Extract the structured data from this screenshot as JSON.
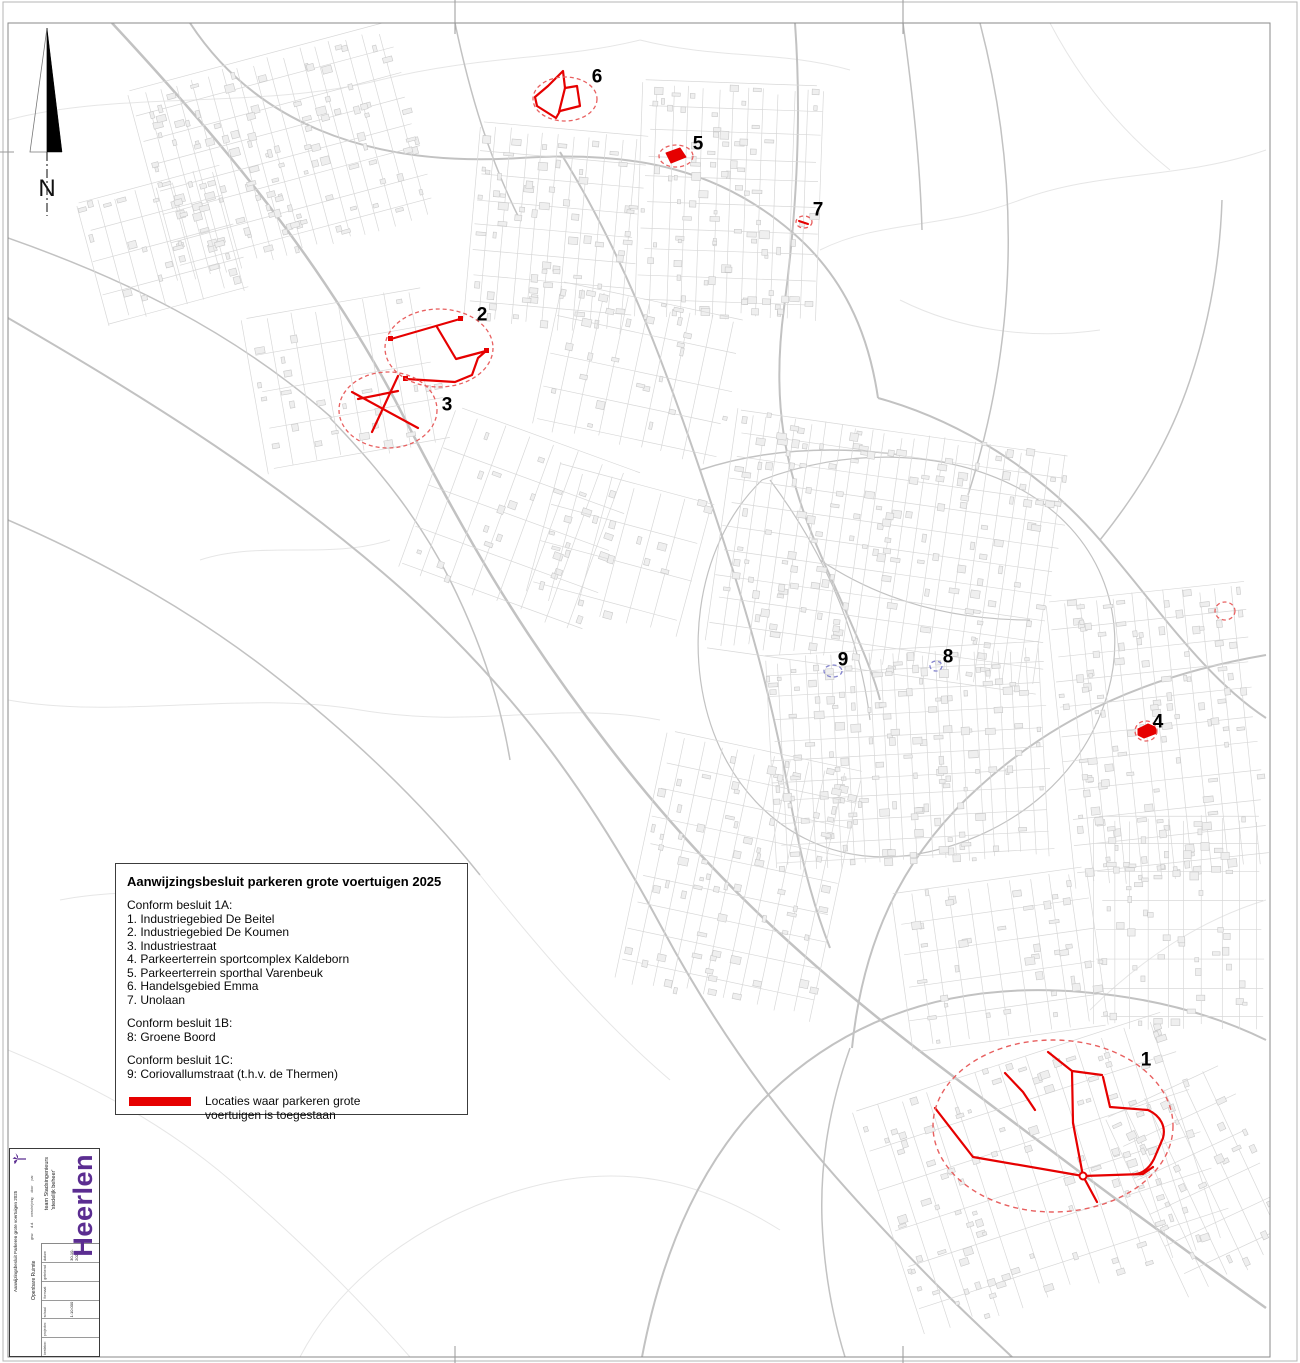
{
  "page": {
    "width": 1300,
    "height": 1363
  },
  "colors": {
    "zone_red": "#e60000",
    "zone_dash_red": "#e86060",
    "zone_dash_blue": "#8585cd",
    "brand_purple": "#5b2d91",
    "map_gray": "#d8d8d8"
  },
  "north_arrow": {
    "label": "N"
  },
  "legend": {
    "title": "Aanwijzingsbesluit parkeren grote voertuigen 2025",
    "sections": [
      {
        "header": "Conform besluit 1A:",
        "items": [
          "1. Industriegebied De Beitel",
          "2. Industriegebied De Koumen",
          "3. Industriestraat",
          "4. Parkeerterrein sportcomplex Kaldeborn",
          "5. Parkeerterrein sporthal Varenbeuk",
          "6. Handelsgebied Emma",
          "7. Unolaan"
        ]
      },
      {
        "header": "Conform besluit 1B:",
        "items": [
          "8: Groene Boord"
        ]
      },
      {
        "header": "Conform besluit 1C:",
        "items": [
          "9: Coriovallumstraat (t.h.v. de Thermen)"
        ]
      }
    ],
    "swatch_label": "Locaties waar parkeren grote voertuigen is toegestaan"
  },
  "markers": [
    {
      "id": "1",
      "label": "1",
      "lx": 1146,
      "ly": 1060,
      "cx": 1053,
      "cy": 1126,
      "rx": 120,
      "ry": 86,
      "color": "red"
    },
    {
      "id": "2",
      "label": "2",
      "lx": 482,
      "ly": 315,
      "cx": 439,
      "cy": 348,
      "rx": 54,
      "ry": 39,
      "color": "red"
    },
    {
      "id": "3",
      "label": "3",
      "lx": 447,
      "ly": 405,
      "cx": 388,
      "cy": 410,
      "rx": 49,
      "ry": 38,
      "color": "red"
    },
    {
      "id": "4",
      "label": "4",
      "lx": 1158,
      "ly": 722,
      "cx": 1146,
      "cy": 731,
      "rx": 11,
      "ry": 10,
      "color": "red"
    },
    {
      "id": "5",
      "label": "5",
      "lx": 698,
      "ly": 144,
      "cx": 676,
      "cy": 156,
      "rx": 17,
      "ry": 11,
      "color": "red"
    },
    {
      "id": "6",
      "label": "6",
      "lx": 597,
      "ly": 77,
      "cx": 565,
      "cy": 99,
      "rx": 32,
      "ry": 22,
      "color": "red"
    },
    {
      "id": "7",
      "label": "7",
      "lx": 818,
      "ly": 210,
      "cx": 804,
      "cy": 222,
      "rx": 8,
      "ry": 6,
      "color": "red"
    },
    {
      "id": "8",
      "label": "8",
      "lx": 948,
      "ly": 657,
      "cx": 936,
      "cy": 666,
      "rx": 6,
      "ry": 5,
      "color": "blue"
    },
    {
      "id": "9",
      "label": "9",
      "lx": 843,
      "ly": 660,
      "cx": 833,
      "cy": 671,
      "rx": 9,
      "ry": 6,
      "color": "blue"
    },
    {
      "id": "extra",
      "label": "",
      "cx": 1225,
      "cy": 611,
      "rx": 10,
      "ry": 9,
      "color": "red"
    }
  ],
  "title_block": {
    "brand": "Heerlen",
    "team_line1": "team Stadsingenieurs",
    "team_line2": "'stedelijk beheer'",
    "department": "Openbare Ruimte",
    "drawing_title": "Aanwijzingsbesluit Parkeren grote voertuigen 2025",
    "revision_headers": [
      "gew.",
      "d.d.",
      "omschrijving",
      "door",
      "par."
    ],
    "fields": [
      {
        "label": "besteknr.",
        "value": ""
      },
      {
        "label": "projectnr.",
        "value": ""
      },
      {
        "label": "schaal",
        "value": "1:10.000"
      },
      {
        "label": "formaat",
        "value": ""
      },
      {
        "label": "getekend",
        "value": ""
      },
      {
        "label": "datum",
        "value": "30-10-2023"
      }
    ]
  }
}
